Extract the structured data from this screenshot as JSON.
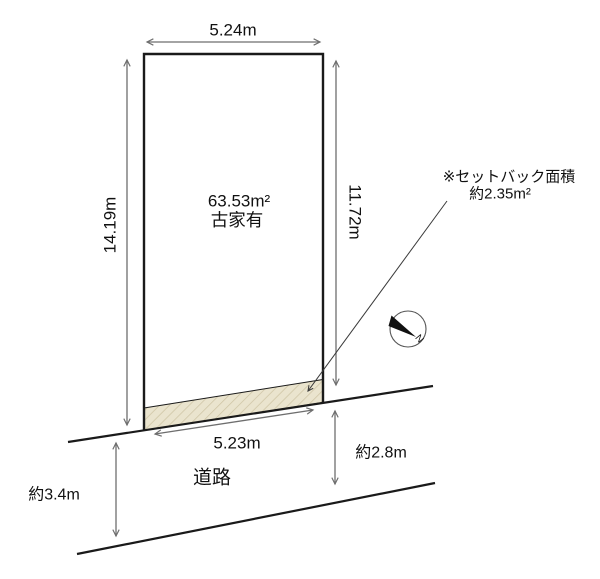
{
  "page": {
    "background": "#ffffff",
    "kind": "land-plot-survey-diagram"
  },
  "plot": {
    "area_label": "63.53m²",
    "building_note": "古家有",
    "width_top": "5.24m",
    "height_left": "14.19m",
    "height_right": "11.72m",
    "frontage_bottom": "5.23m"
  },
  "setback_note": {
    "line1": "※セットバック面積",
    "line2": "約2.35m²"
  },
  "road": {
    "label": "道路",
    "width_left": "約3.4m",
    "width_right": "約2.8m"
  },
  "compass": {
    "letter": "N"
  },
  "colors": {
    "outline": "#1a1a1a",
    "dimension_arrow": "#6e6e6e",
    "leader_line": "#3a3a3a",
    "setback_fill": "#eae4ce",
    "setback_hatch": "#cdc3a2",
    "compass_needle": "#111111",
    "background": "#ffffff"
  }
}
